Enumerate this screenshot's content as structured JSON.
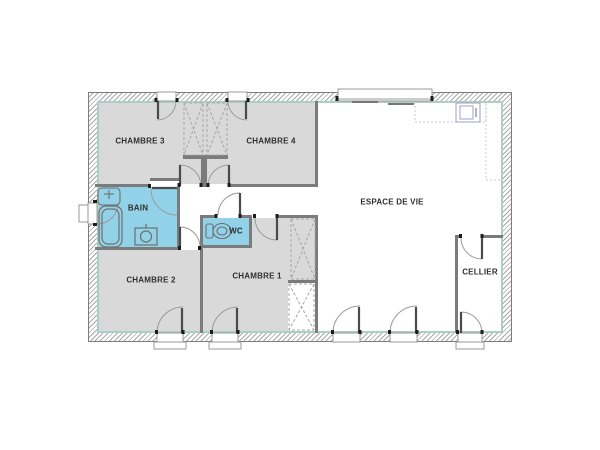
{
  "plan": {
    "title": "Plan de maison / floor plan",
    "rooms": {
      "chambre3": {
        "label": "CHAMBRE 3"
      },
      "chambre4": {
        "label": "CHAMBRE 4"
      },
      "bain": {
        "label": "BAIN"
      },
      "wc": {
        "label": "WC"
      },
      "chambre2": {
        "label": "CHAMBRE 2"
      },
      "chambre1": {
        "label": "CHAMBRE 1"
      },
      "espace_de_vie": {
        "label": "ESPACE DE VIE"
      },
      "cellier": {
        "label": "CELLIER"
      }
    },
    "colors": {
      "room_fill": "#d9d9d9",
      "wet_room_fill": "#92d2e8",
      "wall": "#7b7b7b",
      "insulation_line": "#a9cfc6",
      "label_text": "#2f2f2f",
      "door_arc": "#9b9b9b",
      "door_leaf": "#4a4a4a"
    },
    "icons": [
      "bathtub-icon",
      "washbasin-icon",
      "washer-icon",
      "toilet-icon",
      "kitchen-sink-icon",
      "wardrobe-cross-icon",
      "door-swing-icon",
      "window-icon"
    ]
  }
}
